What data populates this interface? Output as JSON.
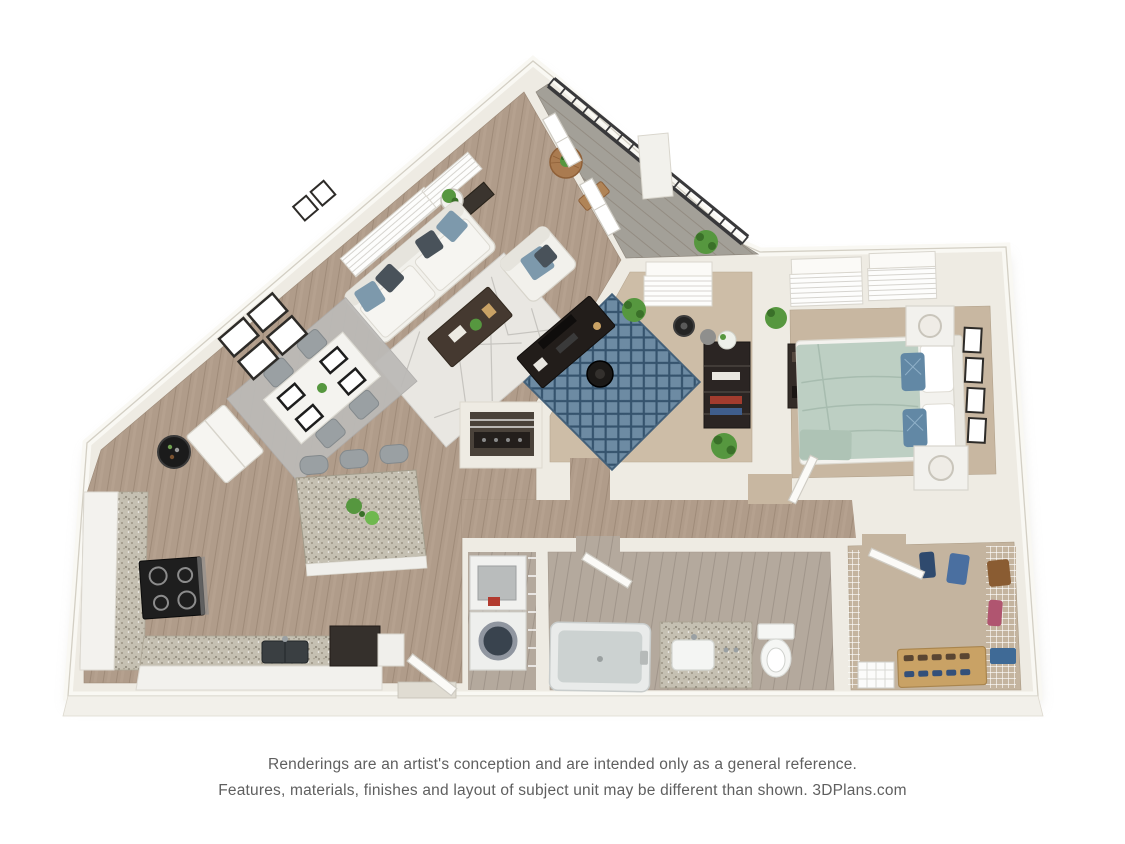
{
  "disclaimer": {
    "line1": "Renderings are an artist's conception and are intended only as a general reference.",
    "line2": "Features, materials, finishes and layout of subject unit may be different than shown. 3DPlans.com"
  },
  "palette": {
    "background": "#ffffff",
    "wall": "#eeebe3",
    "wallEdge": "#d3cfc4",
    "wallHighlight": "#f9f8f3",
    "wood": "#b09c8a",
    "woodGrain": "#9f8b79",
    "bathFloor": "#b4a99d",
    "carpetBedroom": "#c8b7a1",
    "carpetOffice": "#cdbda7",
    "carpetCloset": "#c4b49f",
    "balconyFloor": "#a3a098",
    "granite": "#c5c0b2",
    "railing": "#39393b",
    "sofa": "#f2f1ec",
    "pillowBlue": "#7d99ac",
    "pillowCharcoal": "#49525a",
    "darkWood": "#453930",
    "rugLiving": "#e9e7e2",
    "rugDining": "#bcbab7",
    "rugOfficeBlue": "#6d8ba3",
    "rugOfficeNavy": "#35536d",
    "bedspread": "#bdcfc3",
    "accentBlue": "#6288a5",
    "porcelain": "#f5f6f4",
    "tubInner": "#ccd2d1",
    "applianceBlack": "#1e1e1e",
    "chairGray": "#9aa0a3",
    "plantGreen": "#56973f",
    "balconyWood": "#aa7b50",
    "clothesBlue": "#4a6fa0",
    "clothesBrown": "#8a5c32",
    "shoeRack": "#c9a265",
    "frameDark": "#2d2b28",
    "textGray": "#5f5f5f",
    "detergentRed": "#b23a2f",
    "washerDrum": "#39434e"
  }
}
